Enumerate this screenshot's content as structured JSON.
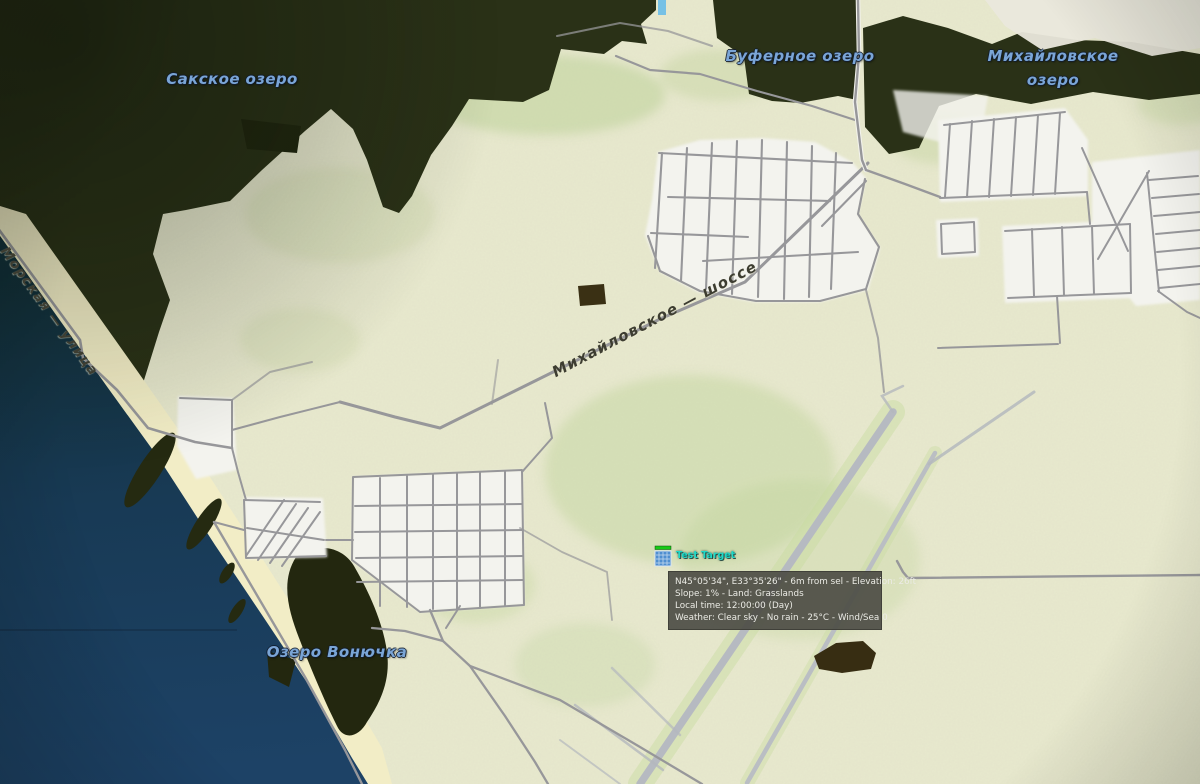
{
  "map": {
    "labels": {
      "sakskoe": "Сакское озеро",
      "bufernoe": "Буферное озеро",
      "mikhaylovskoe1": "Михайловское",
      "mikhaylovskoe2": "озеро",
      "vonyuchka": "Озеро Вонючка",
      "morskaya": "Морская — улица",
      "shosse": "Михайловское — шоссе"
    },
    "unit": {
      "label": "Test Target"
    },
    "tooltip": {
      "lines": [
        "N45°05'34\", E33°35'26\" - 6m from sel - Elevation: 26ft",
        "Slope: 1% - Land: Grasslands",
        "Local time: 12:00:00 (Day)",
        "Weather: Clear sky - No rain - 25°C - Wind/Sea 0"
      ]
    },
    "colors": {
      "sea_deep": "#1d4266",
      "sea_shallow": "#132f38",
      "land": "#e8e9ce",
      "beach": "#f2edc6",
      "lake": "#2a3117",
      "urban": "#f3f3ee",
      "road": "#97979a",
      "runway": "#b6bac1",
      "water_label": "#7aa5d6",
      "road_label": "#3d3d31",
      "unit_label": "#1fd9c8",
      "tooltip_bg": "#4d4d46"
    }
  }
}
